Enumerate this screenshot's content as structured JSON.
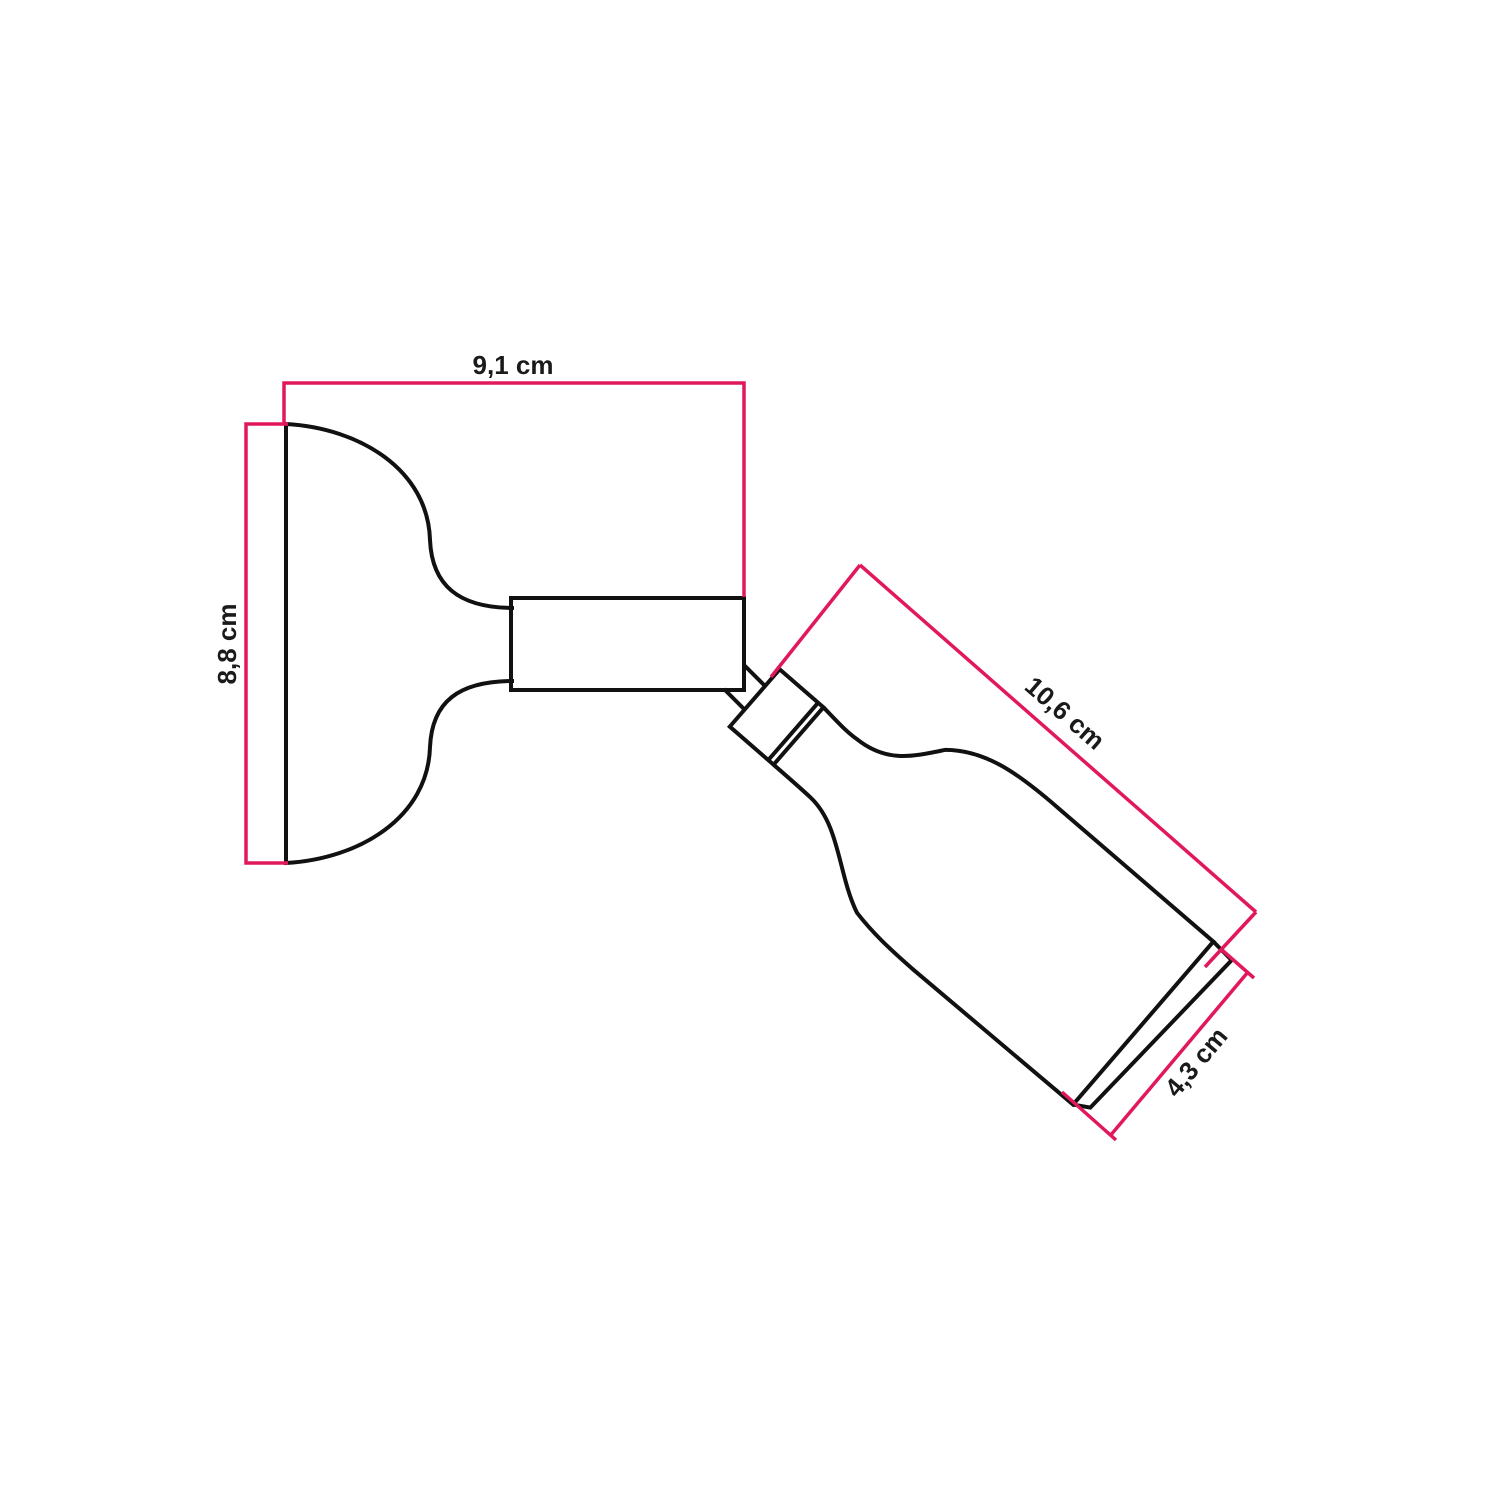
{
  "diagram": {
    "kind": "technical dimension drawing",
    "subject": "adjustable wall lamp with silicone lamp holder",
    "colors": {
      "dimension_line": "#e2185c",
      "outline": "#111111",
      "label_text": "#1a1a1a",
      "background": "#ffffff"
    },
    "dimensions": {
      "base_width": {
        "label": "9,1 cm",
        "value_cm": 9.1
      },
      "base_height": {
        "label": "8,8 cm",
        "value_cm": 8.8
      },
      "holder_length": {
        "label": "10,6 cm",
        "value_cm": 10.6
      },
      "holder_diameter": {
        "label": "4,3 cm",
        "value_cm": 4.3
      }
    }
  }
}
